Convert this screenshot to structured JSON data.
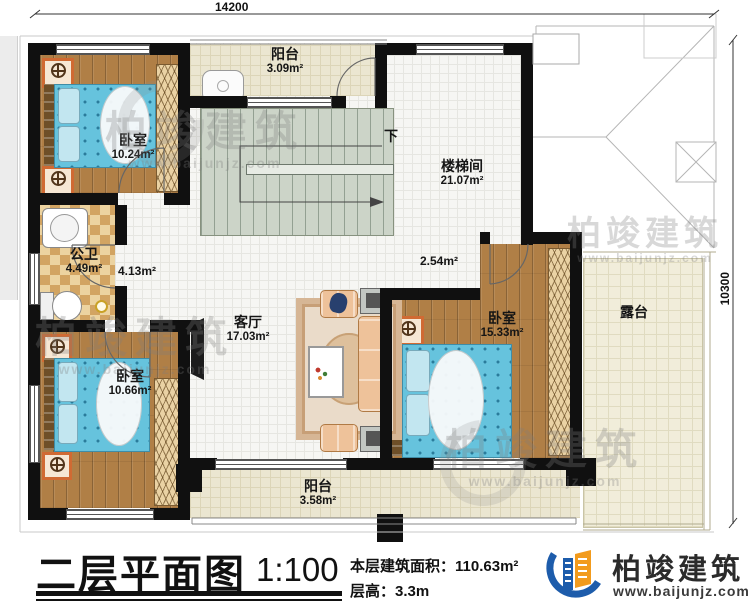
{
  "dimensions": {
    "top": "14200",
    "right": "10300"
  },
  "rooms": [
    {
      "name": "阳台",
      "area": "3.09m²"
    },
    {
      "name": "卧室",
      "area": "10.24m²"
    },
    {
      "name": "楼梯间",
      "area": "21.07m²"
    },
    {
      "name": "公卫",
      "area": "4.49m²"
    },
    {
      "name": "",
      "area": "4.13m²"
    },
    {
      "name": "",
      "area": "2.54m²"
    },
    {
      "name": "客厅",
      "area": "17.03m²"
    },
    {
      "name": "卧室",
      "area": "15.33m²"
    },
    {
      "name": "露台",
      "area": ""
    },
    {
      "name": "卧室",
      "area": "10.66m²"
    },
    {
      "name": "阳台",
      "area": "3.58m²"
    }
  ],
  "stairs": {
    "down_label": "下"
  },
  "title_block": {
    "title": "二层平面图",
    "scale": "1:100",
    "area_label": "本层建筑面积：",
    "area_value": "110.63m²",
    "height_label": "层高：",
    "height_value": "3.3m"
  },
  "brand": {
    "name": "柏竣建筑",
    "url": "www.baijunjz.com"
  },
  "watermark": {
    "name": "柏竣建筑",
    "url": "www.baijunjz.com"
  },
  "colors": {
    "wall": "#101010",
    "wood": "#b07f46",
    "bed_blue": "#66c3dd",
    "checker": "#d2a462",
    "stair": "#ccd4c8",
    "balcony": "#ebe6d1",
    "terrace": "#f1edda",
    "logo_blue": "#1d5cab",
    "logo_orange": "#f29b1d"
  }
}
